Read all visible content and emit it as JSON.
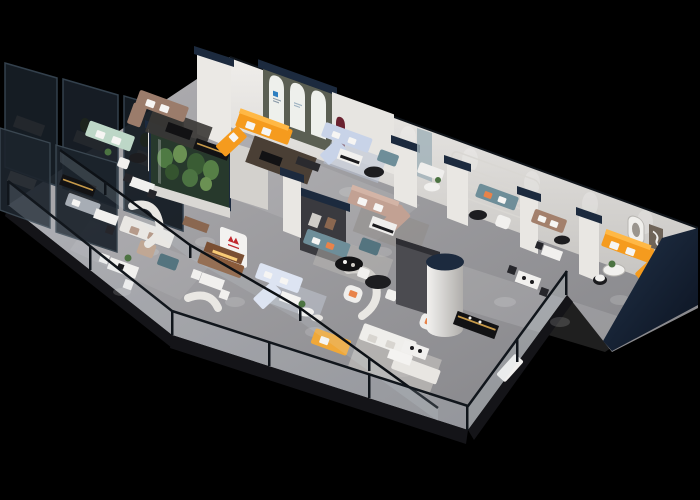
{
  "meta": {
    "type": "3d-isometric-render",
    "subject": "Isometric cutaway floor-plan render of a furniture showroom on a black background",
    "width": 700,
    "height": 500,
    "background": "#000000"
  },
  "palette": {
    "background": "#000000",
    "floor": "#9d9da0",
    "floorLight": "#b9b8ba",
    "slabEdge": "#141418",
    "wall": "#eae8e4",
    "wallShade": "#c9c7c3",
    "capNavy": "#1c2a3e",
    "navyDeep": "#0e1724",
    "glassDark": "#161d25",
    "glassMullion": "#33404c",
    "railGlass": "#cfdbe6",
    "orange": "#f59b1e",
    "orangeLight": "#ffb845",
    "yellow": "#f0a838",
    "mint": "#bdd7c7",
    "taupe": "#9b7c6b",
    "blush": "#c2a193",
    "periwinkle": "#c8d3e8",
    "periLight": "#dde4f2",
    "teal": "#6e8e99",
    "tealDark": "#54747f",
    "charcoal": "#3a3a3f",
    "panelGray": "#4b4b50",
    "maroon": "#6b2330",
    "oliveWall": "#5b5f53",
    "redLogo": "#c1272d",
    "blueLogo": "#2e7fc0",
    "plantGreen": "#4c7342",
    "plantDark": "#35542f",
    "rugWarm": "#4a3f35",
    "rugLight": "#c9c7c2",
    "wood": "#8a6750",
    "cognac": "#8a5b3b",
    "black": "#121214",
    "gold": "#c79a4a",
    "white": "#f4f3f1"
  },
  "scene": {
    "areas": [
      {
        "id": "tinted-glass-offices",
        "label": "dark tinted-glass private rooms, back-left"
      },
      {
        "id": "taupe-sofa-lounge",
        "label": "taupe sofa set, upper left"
      },
      {
        "id": "mint-sofa-lounge",
        "label": "mint green sofa, upper left"
      },
      {
        "id": "arched-niche-wall",
        "label": "olive wall with three white arches and blue logo"
      },
      {
        "id": "orange-sectional-lounge",
        "label": "orange L-sectional below arches"
      },
      {
        "id": "periwinkle-sectional-upper",
        "label": "light blue sectional, top middle"
      },
      {
        "id": "planted-terrarium",
        "label": "glass terrarium with greenery, mid-left"
      },
      {
        "id": "workstation-cubicles",
        "label": "white desks and gray sofas, lower left"
      },
      {
        "id": "cream-sofa-row",
        "label": "cream sofa with wood console, mid-left"
      },
      {
        "id": "cognac-bench-display",
        "label": "cognac leather bench with lit shelf and red logo pillar"
      },
      {
        "id": "charcoal-feature-wall",
        "label": "charcoal media wall with maroon curved accent"
      },
      {
        "id": "teal-lounge",
        "label": "teal sofa with black oval coffee table, center"
      },
      {
        "id": "blush-sectional-lounge",
        "label": "blush sectional with white coffee table, center"
      },
      {
        "id": "round-dining-set",
        "label": "black round table with white chairs"
      },
      {
        "id": "white-cylinder-column",
        "label": "white cylindrical column with navy cap"
      },
      {
        "id": "gray-display-panel",
        "label": "tall warm-gray display panel"
      },
      {
        "id": "periwinkle-sectional-mid",
        "label": "pale blue sectional with round side tables, lower center"
      },
      {
        "id": "yellow-sofa",
        "label": "yellow two-seat sofa at front railing"
      },
      {
        "id": "white-sofa-set",
        "label": "white sofa pair with dining table, bottom center"
      },
      {
        "id": "media-console-black-gold",
        "label": "black media console with gold trim"
      },
      {
        "id": "teal-sofa-right",
        "label": "teal sofa with orange pillows, right"
      },
      {
        "id": "tan-loveseat-right",
        "label": "tan loveseat, right"
      },
      {
        "id": "dining-sets-right",
        "label": "white dining tables with dark chairs, right"
      },
      {
        "id": "stadium-molding-wall",
        "label": "back wall with rounded stadium moldings"
      },
      {
        "id": "orange-wing-room",
        "label": "right wing room with orange sectional and framed art"
      },
      {
        "id": "glass-balustrade",
        "label": "glass railing along the open slab edges"
      }
    ]
  },
  "logos": [
    {
      "id": "red-brand-logo",
      "color": "#c1272d"
    },
    {
      "id": "blue-brand-logo",
      "color": "#2e7fc0"
    }
  ]
}
